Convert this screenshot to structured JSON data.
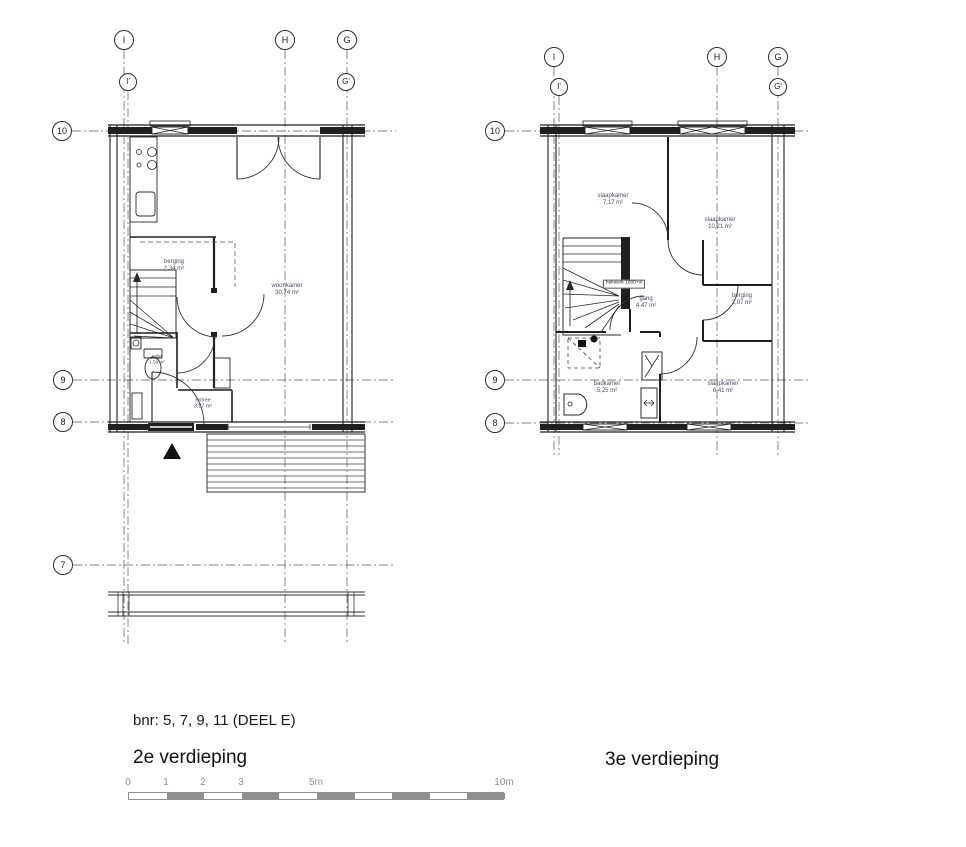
{
  "drawing": {
    "bnr_line": "bnr: 5, 7, 9, 11 (DEEL E)",
    "scale_ticks": [
      "0",
      "1",
      "2",
      "3",
      "5m",
      "10m"
    ]
  },
  "plan_left": {
    "title": "2e verdieping",
    "grid": {
      "top": [
        "I",
        "H",
        "G"
      ],
      "top_sub": [
        "I'",
        "G'"
      ],
      "side": [
        "10",
        "9",
        "8",
        "7"
      ]
    },
    "rooms": {
      "berging": {
        "name": "berging",
        "area": "2,34 m²"
      },
      "woonkamer": {
        "name": "woonkamer",
        "area": "30,74 m²"
      },
      "toilet": {
        "name": "toilet",
        "area": "1,58 m²"
      },
      "entree": {
        "name": "entree",
        "area": "3,87 m²"
      }
    }
  },
  "plan_right": {
    "title": "3e verdieping",
    "grid": {
      "top": [
        "I",
        "H",
        "G"
      ],
      "top_sub": [
        "I'",
        "G'"
      ],
      "side": [
        "10",
        "9",
        "8"
      ]
    },
    "annotation": "hekwerk 1000+vl",
    "rooms": {
      "slaapkamer_1": {
        "name": "slaapkamer",
        "area": "7,17 m²"
      },
      "slaapkamer_2": {
        "name": "slaapkamer",
        "area": "10,21 m²"
      },
      "gang": {
        "name": "gang",
        "area": "4,47 m²"
      },
      "berging": {
        "name": "berging",
        "area": "2,07 m²"
      },
      "badkamer": {
        "name": "badkamer",
        "area": "5,25 m²"
      },
      "slaapkamer_3": {
        "name": "slaapkamer",
        "area": "6,41 m²"
      }
    }
  }
}
